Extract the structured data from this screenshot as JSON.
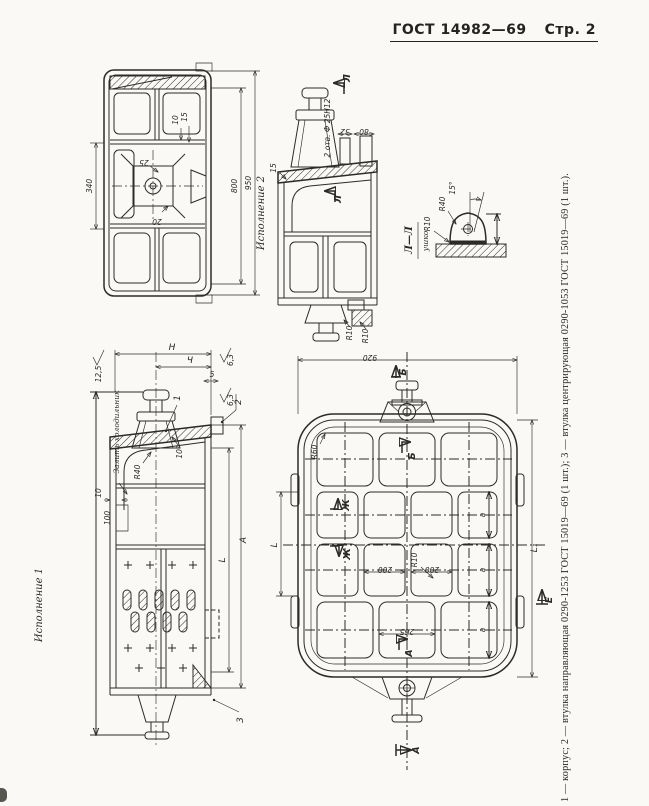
{
  "header": {
    "standard": "ГОСТ 14982—69",
    "page": "Стр. 2"
  },
  "caption": "1 — корпус; 2 — втулка направляющая 0290-1253 ГОСТ 15019—69 (1 шт.); 3 — втулка центрирующая 0290-1053 ГОСТ 15019—69 (1 шт.).",
  "bottom_view": {
    "d340": "340",
    "d800": "800",
    "d950": "950",
    "d10": "10",
    "d15": "15",
    "d25": "25",
    "d20": "20"
  },
  "variant2": {
    "label": "Исполнение 2",
    "holes": "2 отв. Ф 25Н12",
    "d32": "32",
    "d80": "80",
    "d15": "15",
    "sec_top": "Л",
    "sec_mid": "Л",
    "r10a": "R10",
    "r10b": "R10"
  },
  "lug": {
    "title": "Л—Л",
    "subtitle": "ушко",
    "r40": "R40",
    "r10": "R10",
    "angle": "15°"
  },
  "variant1": {
    "label": "Исполнение 1",
    "note": "Залить холодильник",
    "dH": "Н",
    "dCh": "Ч",
    "d5": "5",
    "rough1": "12,5",
    "rough2": "6,3",
    "rough3": "6,3",
    "r40": "R40",
    "angle": "10°",
    "d10": "10",
    "d100": "100",
    "dA": "А",
    "dL": "L",
    "c1": "1",
    "c2": "2",
    "c3": "3"
  },
  "plan": {
    "d920": "920",
    "r60": "R60",
    "r10": "R10",
    "d200a": "200",
    "d200b": "200",
    "d265": "265",
    "a1": "a",
    "a2": "a",
    "a3": "a",
    "dL": "L",
    "dL1": "L₁",
    "sec_b_top": "Б",
    "sec_b_in": "Б",
    "sec_zh1": "Ж",
    "sec_zh2": "Ж",
    "sec_a_in": "А",
    "sec_a_out": "А",
    "sec_e": "Е"
  }
}
